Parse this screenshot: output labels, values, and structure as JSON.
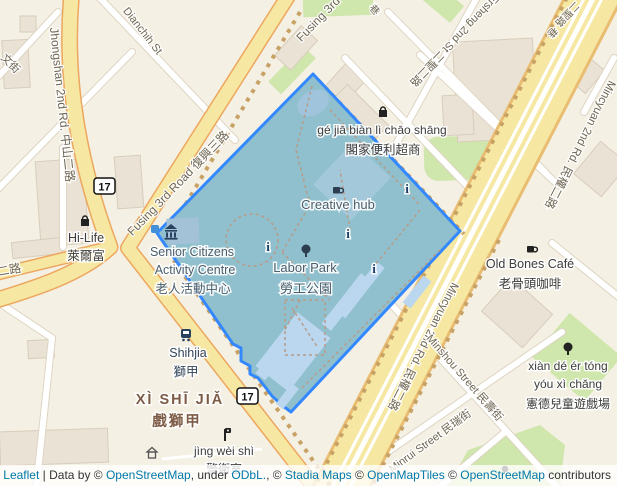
{
  "colors": {
    "highlight_stroke": "#3388ff",
    "highlight_fill": "#90c0cd",
    "road_yellow": "#f6e8a3",
    "road_casing": "#eda75f",
    "land": "#f5f0e4",
    "green": "#cfe6ad",
    "water": "#bad7ef",
    "link": "#0078a8"
  },
  "icons": {
    "info_glyph": "i"
  },
  "shields": {
    "route17": "17"
  },
  "roads": {
    "jhongshan": "Jhongshan 2nd Rd. 中山二路",
    "dianchih": "Dianchih St",
    "wen_street_partial": "文街",
    "ersheng_west_partial": "二聖二路",
    "fusing": "Fusing 3rd Road 復興三路",
    "ersheng_ne": "Ersheng 2nd St 二聖二路",
    "lane1": "巷",
    "lane2": "巷",
    "ersheng_lane_partial": "二聖路",
    "mincyuan": "Mincyuan 2nd Rd. 民權二路",
    "minshou": "Minshou Street 民壽街",
    "minrui": "Minrui Street 民瑞街"
  },
  "pois": {
    "hilife_en": "Hi-Life",
    "hilife_zh": "萊爾富",
    "gejia_pinyin": "gé jiā biàn lì chāo shāng",
    "gejia_zh": "閣家便利超商",
    "creative_hub": "Creative hub",
    "senior_1": "Senior Citizens",
    "senior_2": "Activity Centre",
    "senior_zh": "老人活動中心",
    "labor_park_en": "Labor Park",
    "labor_park_zh": "勞工公園",
    "shihjia_en": "Shihjia",
    "shihjia_zh": "獅甲",
    "xishijia_pinyin": "XÌ SHĪ JIǍ",
    "xishijia_zh": "戲獅甲",
    "jingweishi_pinyin": "jìng wèi shì",
    "jingweishi_zh": "警衛室",
    "oldbones_en": "Old Bones Café",
    "oldbones_zh": "老骨頭咖啡",
    "xiande_1": "xiàn dé ér tóng",
    "xiande_2": "yóu xì chǎng",
    "xiande_zh": "憲德兒童遊戲場"
  },
  "attribution": {
    "leaflet": "Leaflet",
    "sep1": " | Data by © ",
    "osm1": "OpenStreetMap",
    "sep2": ", under ",
    "odbl": "ODbL.",
    "sep3": ", © ",
    "stadia": "Stadia Maps",
    "sep4": " © ",
    "openmaptiles": "OpenMapTiles",
    "sep5": " © ",
    "osm2": "OpenStreetMap",
    "sep6": " contributors"
  }
}
